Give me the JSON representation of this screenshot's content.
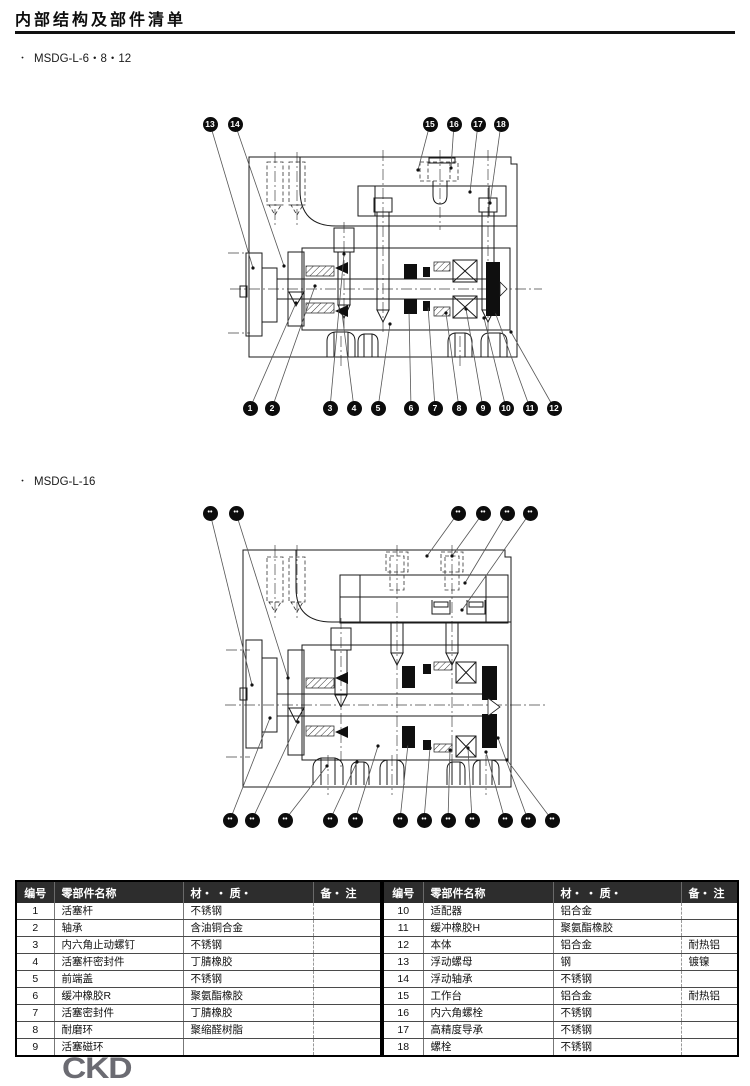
{
  "page": {
    "title": "内部结构及部件清单",
    "logo": "CKD"
  },
  "sections": [
    {
      "bullet": "・",
      "label": "MSDG-L-6・8・12"
    },
    {
      "bullet": "・",
      "label": "MSDG-L-16"
    }
  ],
  "diagram1": {
    "callouts": [
      {
        "n": "13",
        "x": 210,
        "y": 124,
        "tx": 253,
        "ty": 268
      },
      {
        "n": "14",
        "x": 235,
        "y": 124,
        "tx": 284,
        "ty": 266
      },
      {
        "n": "15",
        "x": 430,
        "y": 124,
        "tx": 418,
        "ty": 170
      },
      {
        "n": "16",
        "x": 454,
        "y": 124,
        "tx": 451,
        "ty": 168
      },
      {
        "n": "17",
        "x": 478,
        "y": 124,
        "tx": 470,
        "ty": 192
      },
      {
        "n": "18",
        "x": 501,
        "y": 124,
        "tx": 490,
        "ty": 203
      },
      {
        "n": "1",
        "x": 250,
        "y": 408,
        "tx": 296,
        "ty": 303
      },
      {
        "n": "2",
        "x": 272,
        "y": 408,
        "tx": 315,
        "ty": 286
      },
      {
        "n": "3",
        "x": 330,
        "y": 408,
        "tx": 344,
        "ty": 254
      },
      {
        "n": "4",
        "x": 354,
        "y": 408,
        "tx": 342,
        "ty": 313
      },
      {
        "n": "5",
        "x": 378,
        "y": 408,
        "tx": 390,
        "ty": 324
      },
      {
        "n": "6",
        "x": 411,
        "y": 408,
        "tx": 409,
        "ty": 312
      },
      {
        "n": "7",
        "x": 435,
        "y": 408,
        "tx": 428,
        "ty": 306
      },
      {
        "n": "8",
        "x": 459,
        "y": 408,
        "tx": 446,
        "ty": 313
      },
      {
        "n": "9",
        "x": 483,
        "y": 408,
        "tx": 466,
        "ty": 309
      },
      {
        "n": "10",
        "x": 506,
        "y": 408,
        "tx": 484,
        "ty": 318
      },
      {
        "n": "11",
        "x": 530,
        "y": 408,
        "tx": 495,
        "ty": 312
      },
      {
        "n": "12",
        "x": 554,
        "y": 408,
        "tx": 511,
        "ty": 332
      }
    ]
  },
  "diagram2": {
    "callouts": [
      {
        "n": "••",
        "x": 210,
        "y": 513,
        "tx": 252,
        "ty": 685
      },
      {
        "n": "••",
        "x": 236,
        "y": 513,
        "tx": 288,
        "ty": 678
      },
      {
        "n": "••",
        "x": 458,
        "y": 513,
        "tx": 427,
        "ty": 556
      },
      {
        "n": "••",
        "x": 483,
        "y": 513,
        "tx": 452,
        "ty": 556
      },
      {
        "n": "••",
        "x": 507,
        "y": 513,
        "tx": 465,
        "ty": 583
      },
      {
        "n": "••",
        "x": 530,
        "y": 513,
        "tx": 462,
        "ty": 610
      },
      {
        "n": "••",
        "x": 230,
        "y": 820,
        "tx": 270,
        "ty": 718
      },
      {
        "n": "••",
        "x": 252,
        "y": 820,
        "tx": 298,
        "ty": 722
      },
      {
        "n": "••",
        "x": 285,
        "y": 820,
        "tx": 327,
        "ty": 766
      },
      {
        "n": "••",
        "x": 330,
        "y": 820,
        "tx": 357,
        "ty": 762
      },
      {
        "n": "••",
        "x": 355,
        "y": 820,
        "tx": 378,
        "ty": 746
      },
      {
        "n": "••",
        "x": 400,
        "y": 820,
        "tx": 408,
        "ty": 744
      },
      {
        "n": "••",
        "x": 424,
        "y": 820,
        "tx": 430,
        "ty": 748
      },
      {
        "n": "••",
        "x": 448,
        "y": 820,
        "tx": 450,
        "ty": 750
      },
      {
        "n": "••",
        "x": 472,
        "y": 820,
        "tx": 468,
        "ty": 748
      },
      {
        "n": "••",
        "x": 505,
        "y": 820,
        "tx": 486,
        "ty": 752
      },
      {
        "n": "••",
        "x": 528,
        "y": 820,
        "tx": 498,
        "ty": 738
      },
      {
        "n": "••",
        "x": 552,
        "y": 820,
        "tx": 507,
        "ty": 760
      }
    ]
  },
  "table": {
    "headers": [
      "编号",
      "零部件名称",
      "材・ ・ 质・",
      "备・ 注"
    ],
    "left": [
      {
        "no": "1",
        "name": "活塞杆",
        "material": "不锈钢",
        "note": ""
      },
      {
        "no": "2",
        "name": "轴承",
        "material": "含油铜合金",
        "note": ""
      },
      {
        "no": "3",
        "name": "内六角止动螺钉",
        "material": "不锈钢",
        "note": ""
      },
      {
        "no": "4",
        "name": "活塞杆密封件",
        "material": "丁腈橡胶",
        "note": ""
      },
      {
        "no": "5",
        "name": "前端盖",
        "material": "不锈钢",
        "note": ""
      },
      {
        "no": "6",
        "name": "缓冲橡胶R",
        "material": "聚氨酯橡胶",
        "note": ""
      },
      {
        "no": "7",
        "name": "活塞密封件",
        "material": "丁腈橡胶",
        "note": ""
      },
      {
        "no": "8",
        "name": "耐磨环",
        "material": "聚缩醛树脂",
        "note": ""
      },
      {
        "no": "9",
        "name": "活塞磁环",
        "material": "",
        "note": ""
      }
    ],
    "right": [
      {
        "no": "10",
        "name": "适配器",
        "material": "铝合金",
        "note": ""
      },
      {
        "no": "11",
        "name": "缓冲橡胶H",
        "material": "聚氨酯橡胶",
        "note": ""
      },
      {
        "no": "12",
        "name": "本体",
        "material": "铝合金",
        "note": "耐热铝"
      },
      {
        "no": "13",
        "name": "浮动螺母",
        "material": "钢",
        "note": "镀镍"
      },
      {
        "no": "14",
        "name": "浮动轴承",
        "material": "不锈钢",
        "note": ""
      },
      {
        "no": "15",
        "name": "工作台",
        "material": "铝合金",
        "note": "耐热铝"
      },
      {
        "no": "16",
        "name": "内六角螺栓",
        "material": "不锈钢",
        "note": ""
      },
      {
        "no": "17",
        "name": "高精度导承",
        "material": "不锈钢",
        "note": ""
      },
      {
        "no": "18",
        "name": "螺栓",
        "material": "不锈钢",
        "note": ""
      }
    ]
  }
}
